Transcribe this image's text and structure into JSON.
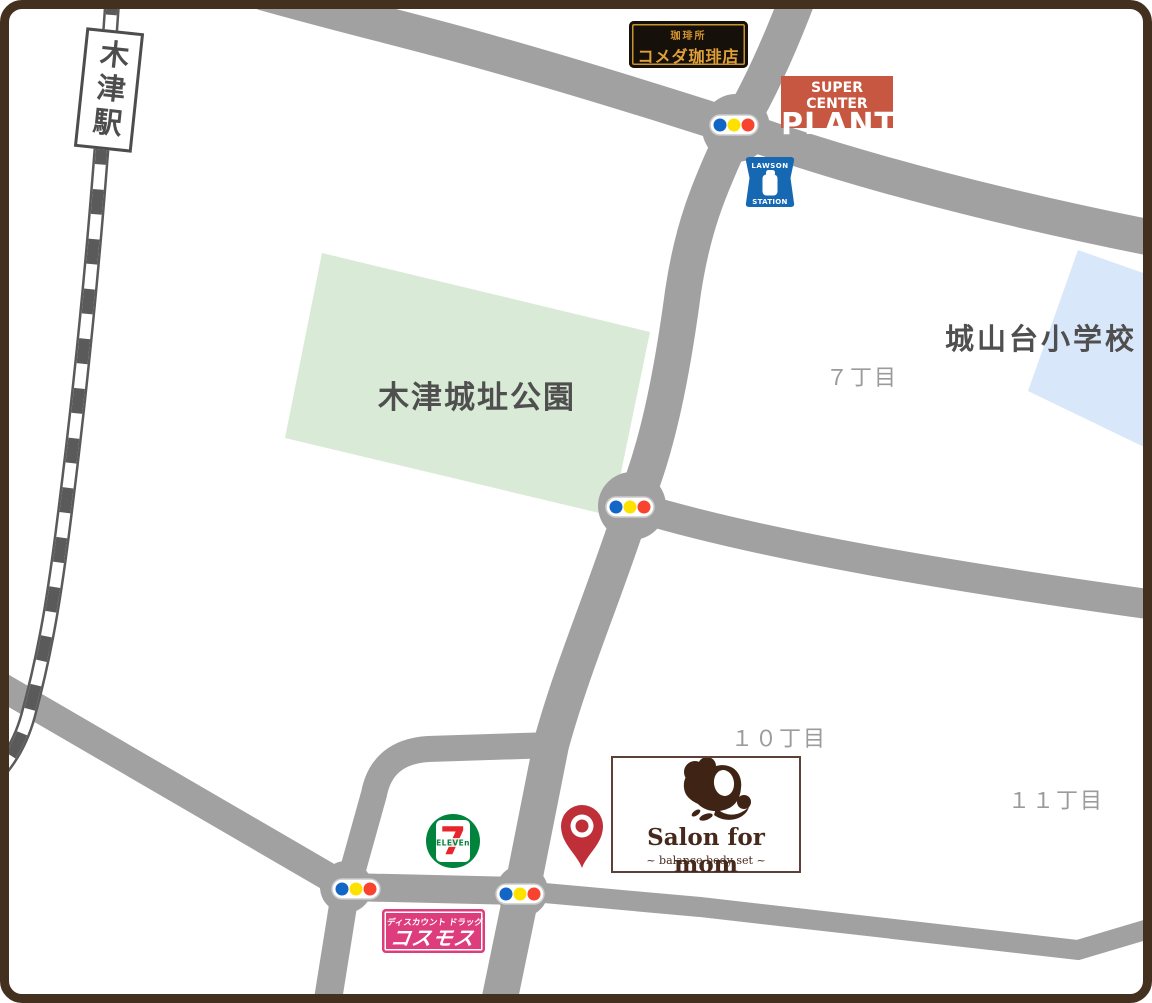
{
  "station": {
    "label": "木津駅"
  },
  "areas": {
    "park": "木津城址公園",
    "school": "城山台小学校"
  },
  "districts": {
    "d7": "７丁目",
    "d10": "１０丁目",
    "d11": "１１丁目"
  },
  "komeda": {
    "line1": "珈琲所",
    "line2": "コメダ珈琲店"
  },
  "plant": {
    "line1": "SUPER CENTER",
    "line2": "PLANT"
  },
  "lawson": {
    "top": "LAWSON",
    "bottom": "STATION"
  },
  "seven": {
    "digit": "7",
    "word": "ELEVEn"
  },
  "cosmos": {
    "line1": "ディスカウント ドラッグ",
    "line2": "コスモス"
  },
  "salon": {
    "title": "Salon for mom",
    "subtitle": "~ balance body set ~"
  },
  "colors": {
    "frame_brown": "#43301e",
    "road_gray": "#a1a1a1",
    "park_green": "#d9ead6",
    "school_blue": "#d9e7fb",
    "signal_blue": "#1266c5",
    "signal_yellow": "#ffe100",
    "signal_red": "#f8432e",
    "pin_red": "#bf2f38",
    "plant_red": "#c75740",
    "cosmos_pink": "#dd3d7d",
    "komeda_gold": "#c8932f",
    "lawson_blue": "#1668b2",
    "seven_green": "#00843d",
    "seven_red": "#e7252a",
    "text_dark": "#4f4f4f",
    "text_district": "#9b9b9b"
  }
}
